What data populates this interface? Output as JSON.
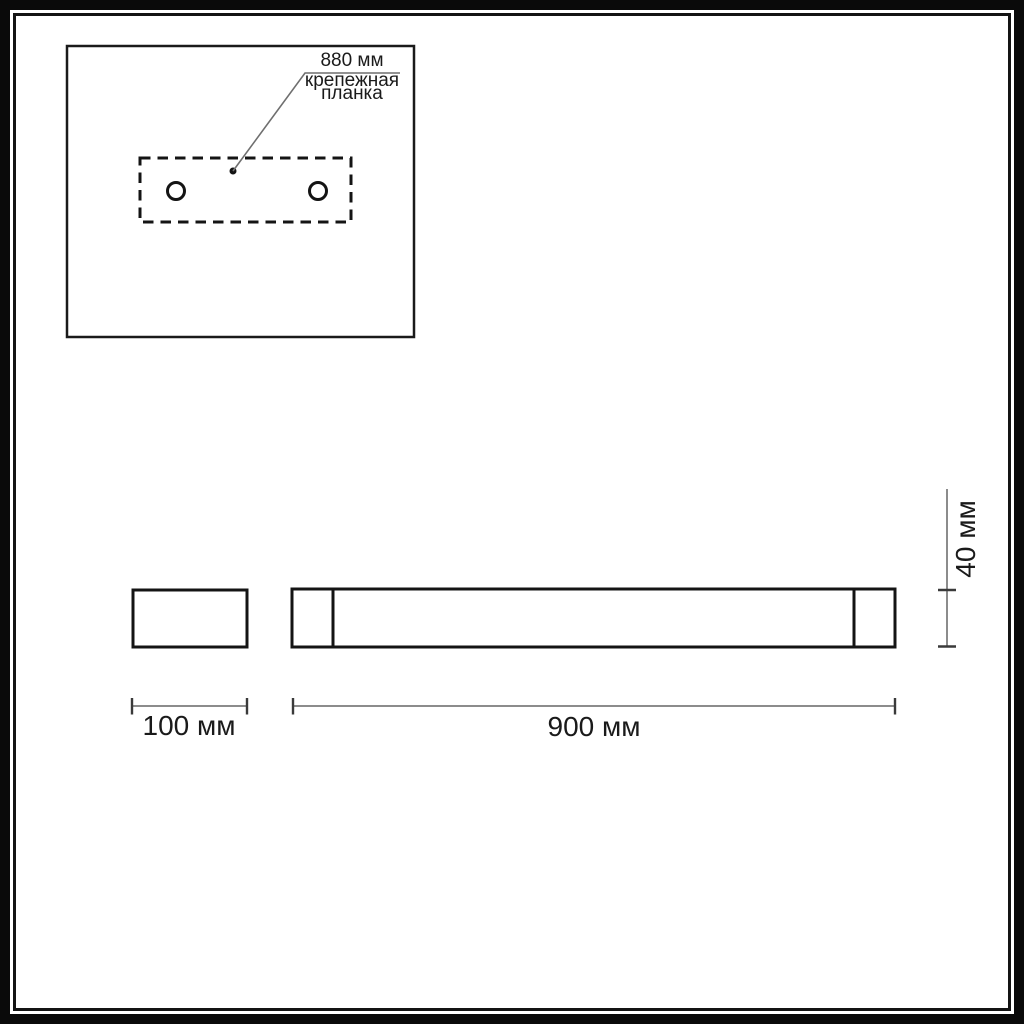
{
  "callout": {
    "dimension": "880 мм",
    "label_line1": "крепежная",
    "label_line2": "планка"
  },
  "dimensions": {
    "depth": "100 мм",
    "length": "900 мм",
    "height": "40 мм"
  },
  "colors": {
    "ink": "#1a1a1a",
    "dim_line": "#8c8c8c",
    "tick": "#3a3a3a",
    "background": "#ffffff"
  }
}
